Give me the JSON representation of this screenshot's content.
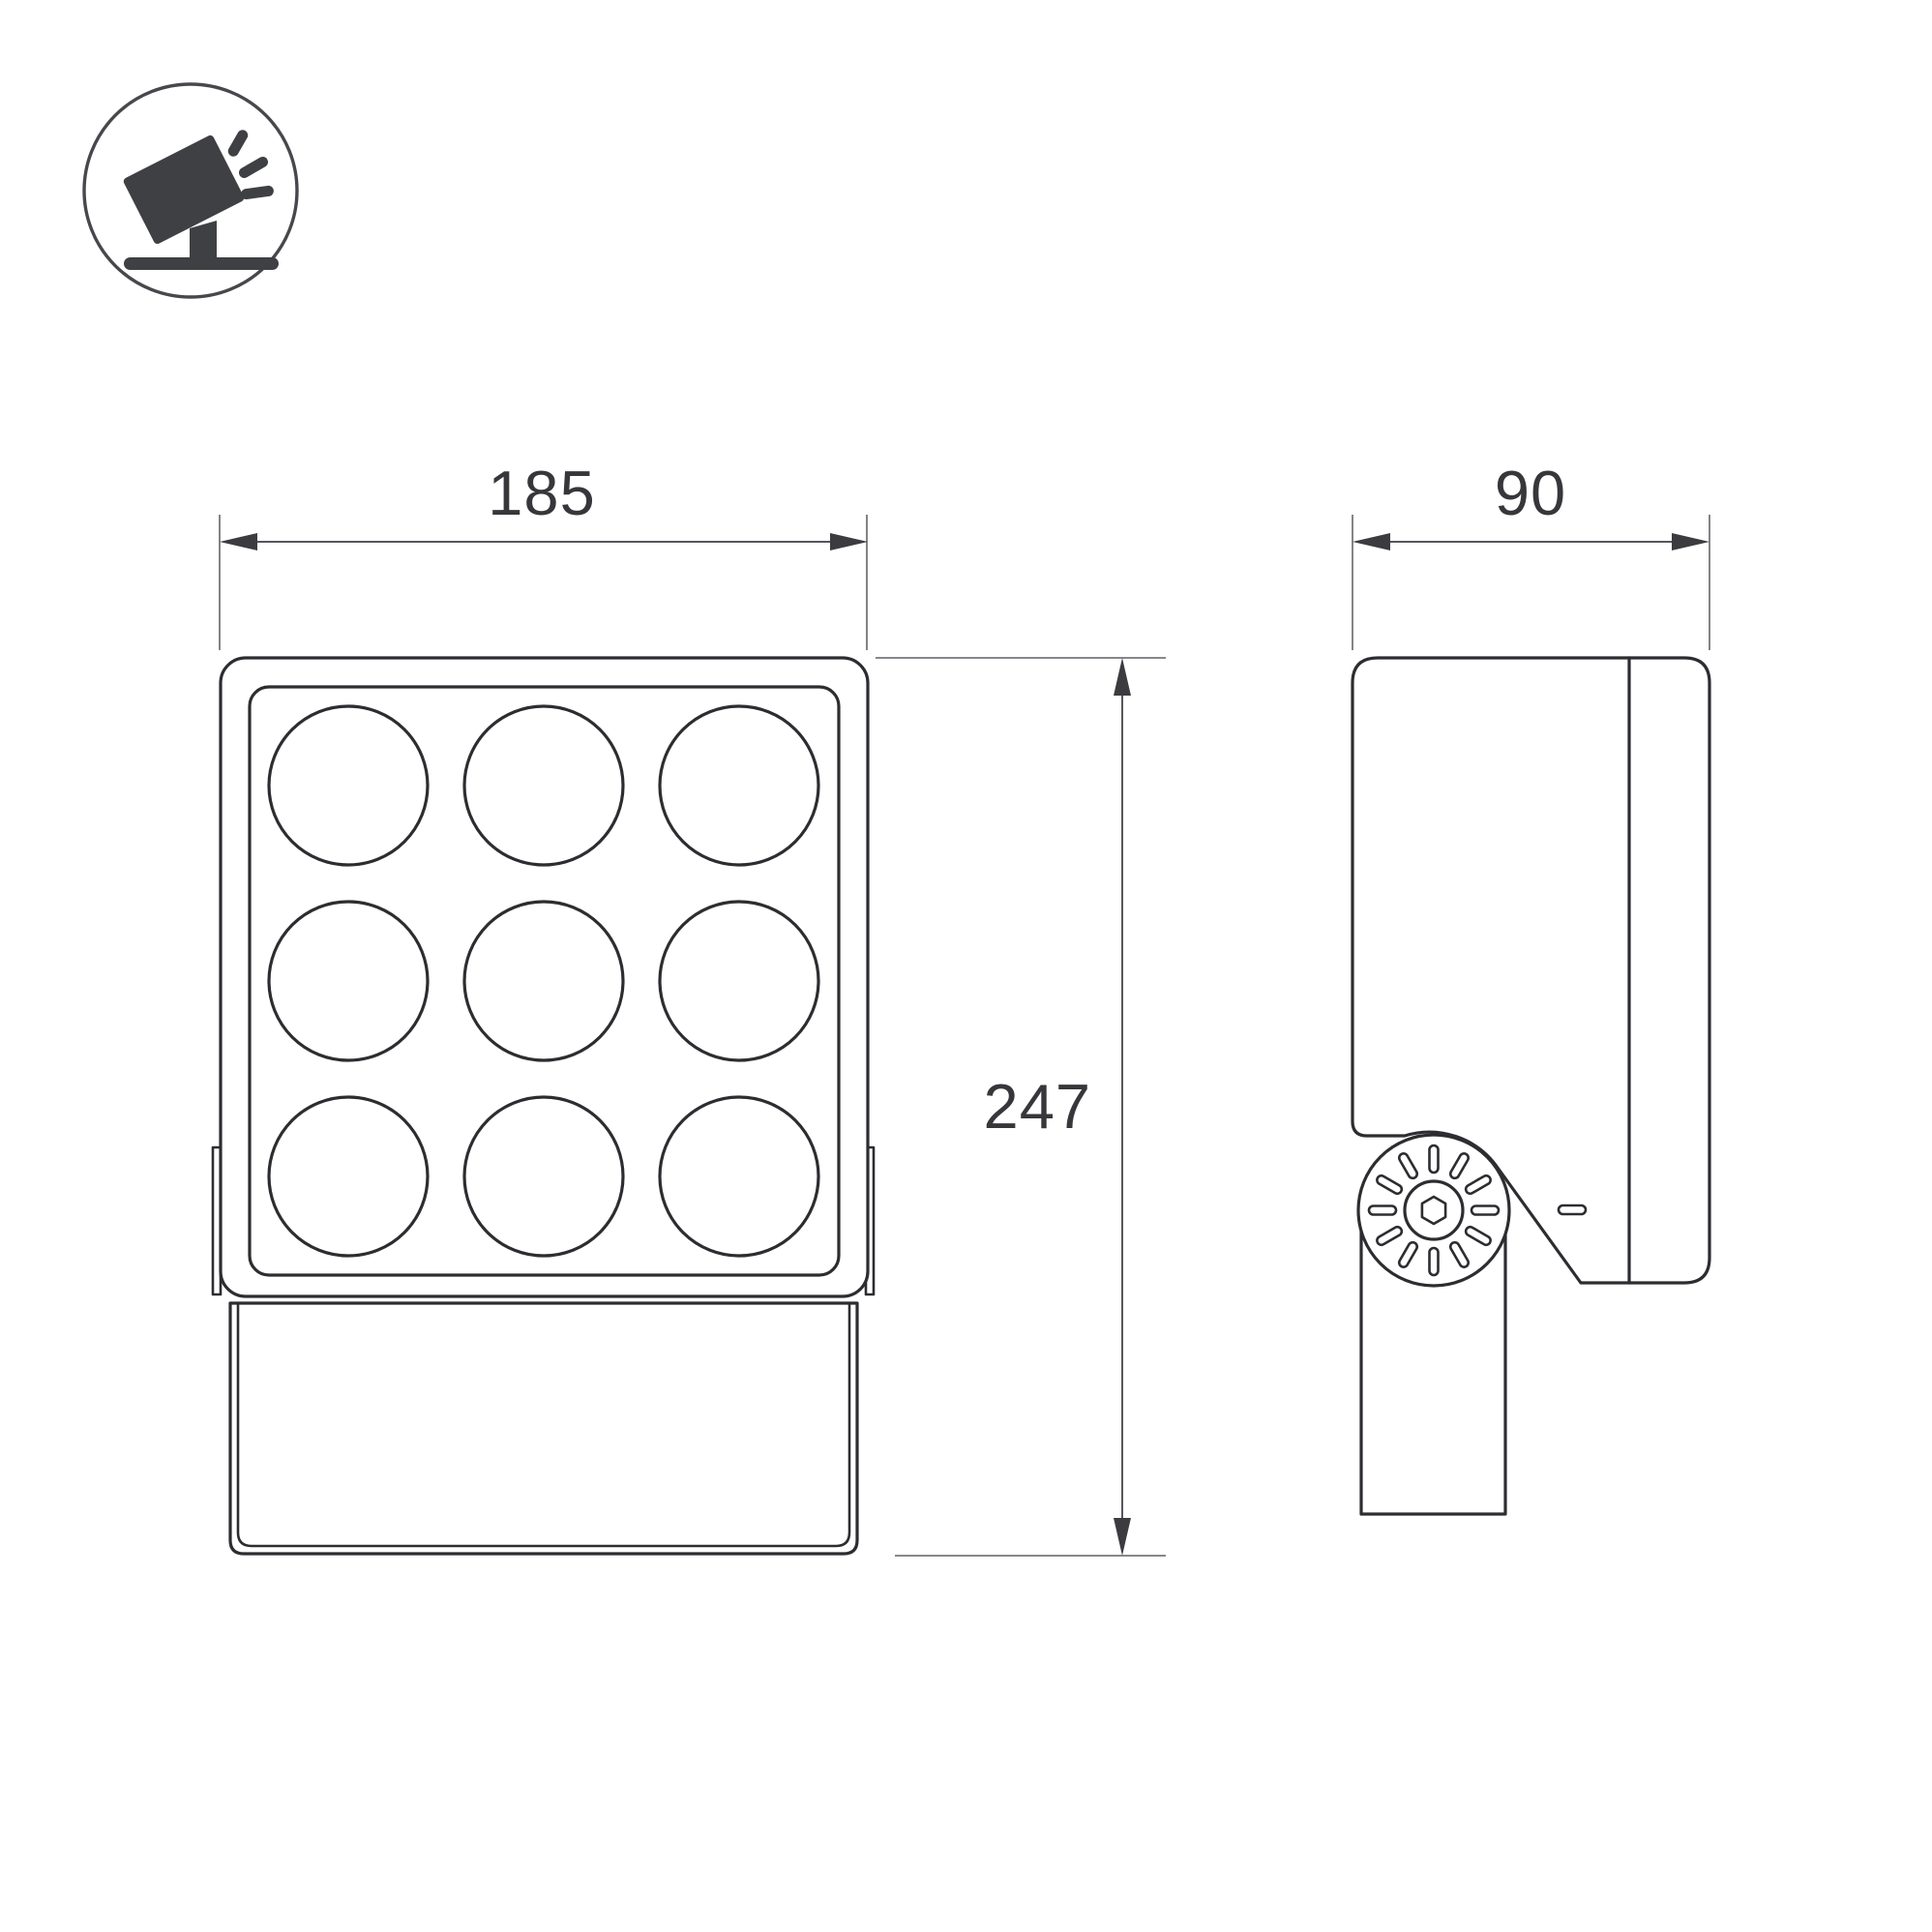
{
  "drawing": {
    "type": "product-dimension-diagram",
    "product": "led-floodlight-9-lens"
  },
  "legend_icon": {
    "name": "tilted-floodlight-on-stand-icon"
  },
  "dims": {
    "front_width": "185",
    "side_width": "90",
    "front_height": "247"
  },
  "front_view": {
    "lens_rows": 3,
    "lens_cols": 3,
    "lens_count": 9
  },
  "side_view": {
    "knuckle_slots": 12,
    "screw": "hex-socket"
  },
  "colors": {
    "background": "#ffffff",
    "outline": "#2d2d31",
    "dimension_line": "#56565b",
    "extension_line": "#76767b",
    "arrow": "#3c3c40",
    "text": "#37373b",
    "icon_fill": "#3f4043",
    "icon_ring": "#47484c"
  }
}
